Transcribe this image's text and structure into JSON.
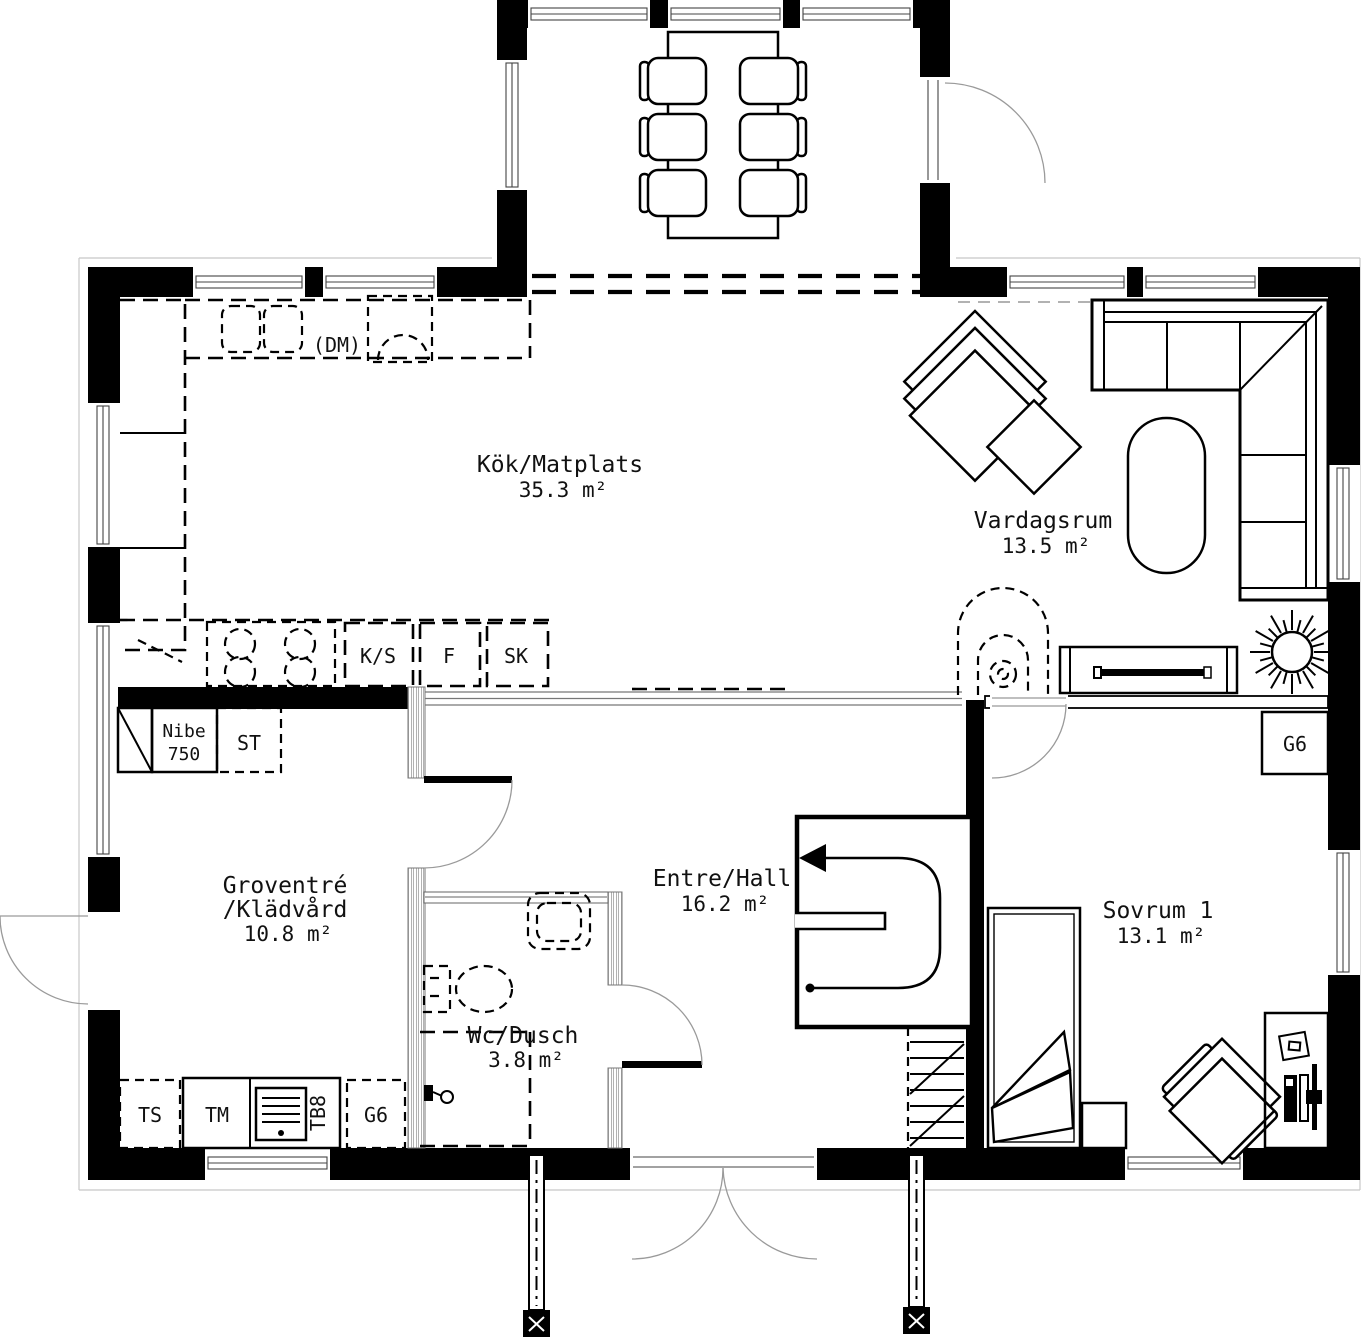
{
  "rooms": {
    "kitchen": {
      "name": "Kök/Matplats",
      "area": "35.3 m²"
    },
    "living": {
      "name": "Vardagsrum",
      "area": "13.5 m²"
    },
    "utility": {
      "name1": "Groventré",
      "name2": "/Klädvård",
      "area": "10.8 m²"
    },
    "hall": {
      "name": "Entre/Hall",
      "area": "16.2 m²"
    },
    "wc": {
      "name": "Wc/Dusch",
      "area": "3.8 m²"
    },
    "bedroom": {
      "name": "Sovrum 1",
      "area": "13.1 m²"
    }
  },
  "labels": {
    "dm": "(DM)",
    "ks": "K/S",
    "f": "F",
    "sk": "SK",
    "nibe1": "Nibe",
    "nibe2": "750",
    "st": "ST",
    "g6_bedroom": "G6",
    "ts": "TS",
    "tm": "TM",
    "tb8": "TB8",
    "g6_utility": "G6"
  },
  "colors": {
    "wall": "#000000",
    "background": "#ffffff"
  }
}
